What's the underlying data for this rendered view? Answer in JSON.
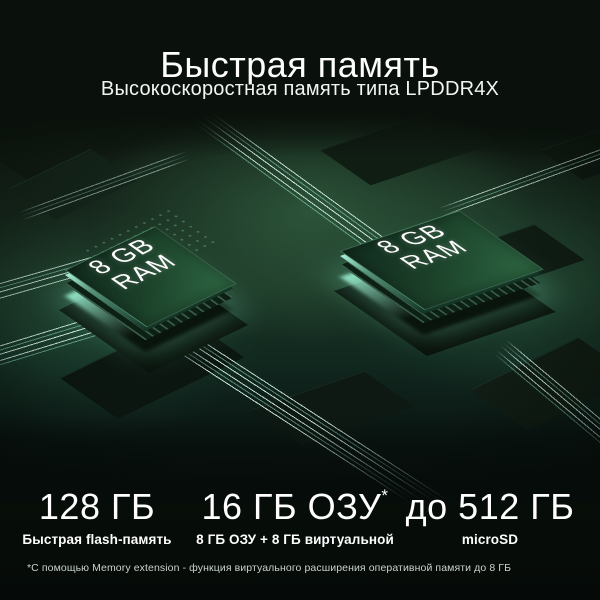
{
  "header": {
    "title": "Быстрая память",
    "subtitle": "Высокоскоростная память типа LPDDR4X"
  },
  "chips": [
    {
      "line1": "8 GB",
      "line2": "RAM"
    },
    {
      "line1": "8 GB",
      "line2": "RAM"
    }
  ],
  "specs": [
    {
      "value": "128 ГБ",
      "sup": "",
      "label": "Быстрая flash-память"
    },
    {
      "value": "16 ГБ ОЗУ",
      "sup": "*",
      "label": "8 ГБ ОЗУ + 8 ГБ виртуальной"
    },
    {
      "value": "до 512 ГБ",
      "sup": "",
      "label": "microSD"
    }
  ],
  "footnote": "*С помощью Memory extension -  функция виртуального расширения оперативной памяти до 8 ГБ",
  "colors": {
    "background": "#070c08",
    "accent_glow": "#9fe6cf",
    "chip_green": "#2e6a46",
    "text": "#ffffff",
    "footnote_text": "#c9d2cb"
  }
}
